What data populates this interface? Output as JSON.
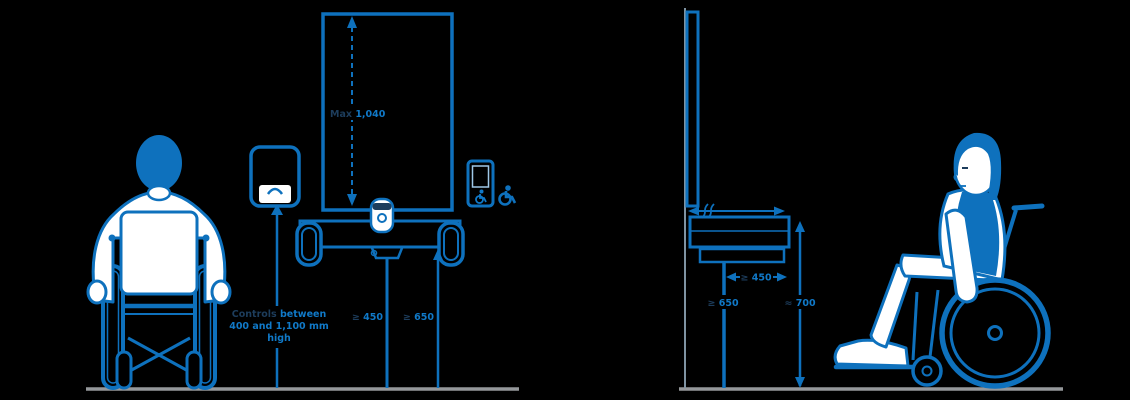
{
  "illustration": {
    "title": "accessible-counter-and-wheelchair-user-diagram",
    "colors": {
      "primary_blue": "#0e71bd",
      "dark_navy": "#1d3d5c",
      "white": "#ffffff",
      "ground_gray": "#95989b",
      "background": "#000000"
    },
    "left_scene": {
      "panel_height_label": {
        "prefix": "Max ",
        "value": "1,040"
      },
      "device_caption": {
        "line1_emphasis": "Controls",
        "line1_rest": " between",
        "line2": "400 and 1,100 mm",
        "line3": "high"
      },
      "table_depth_label": {
        "symbol": "≥ ",
        "value": "450"
      },
      "table_clearance_label": {
        "symbol": "≥ ",
        "value": "650"
      },
      "icons": [
        "wheelchair-user-front-icon",
        "intercom-device-icon",
        "privacy-panel",
        "grab-handle-icon",
        "camera-device-icon",
        "phone-with-isa-icon",
        "isa-symbol-icon"
      ]
    },
    "right_scene": {
      "knee_depth_label": {
        "symbol": "≥ ",
        "value": "450"
      },
      "knee_height_label": {
        "symbol": "≥ ",
        "value": "650"
      },
      "counter_height_label": {
        "symbol": "≈ ",
        "value": "700"
      },
      "icons": [
        "privacy-panel-side",
        "counter-side",
        "wheelchair-user-side-icon"
      ]
    }
  }
}
